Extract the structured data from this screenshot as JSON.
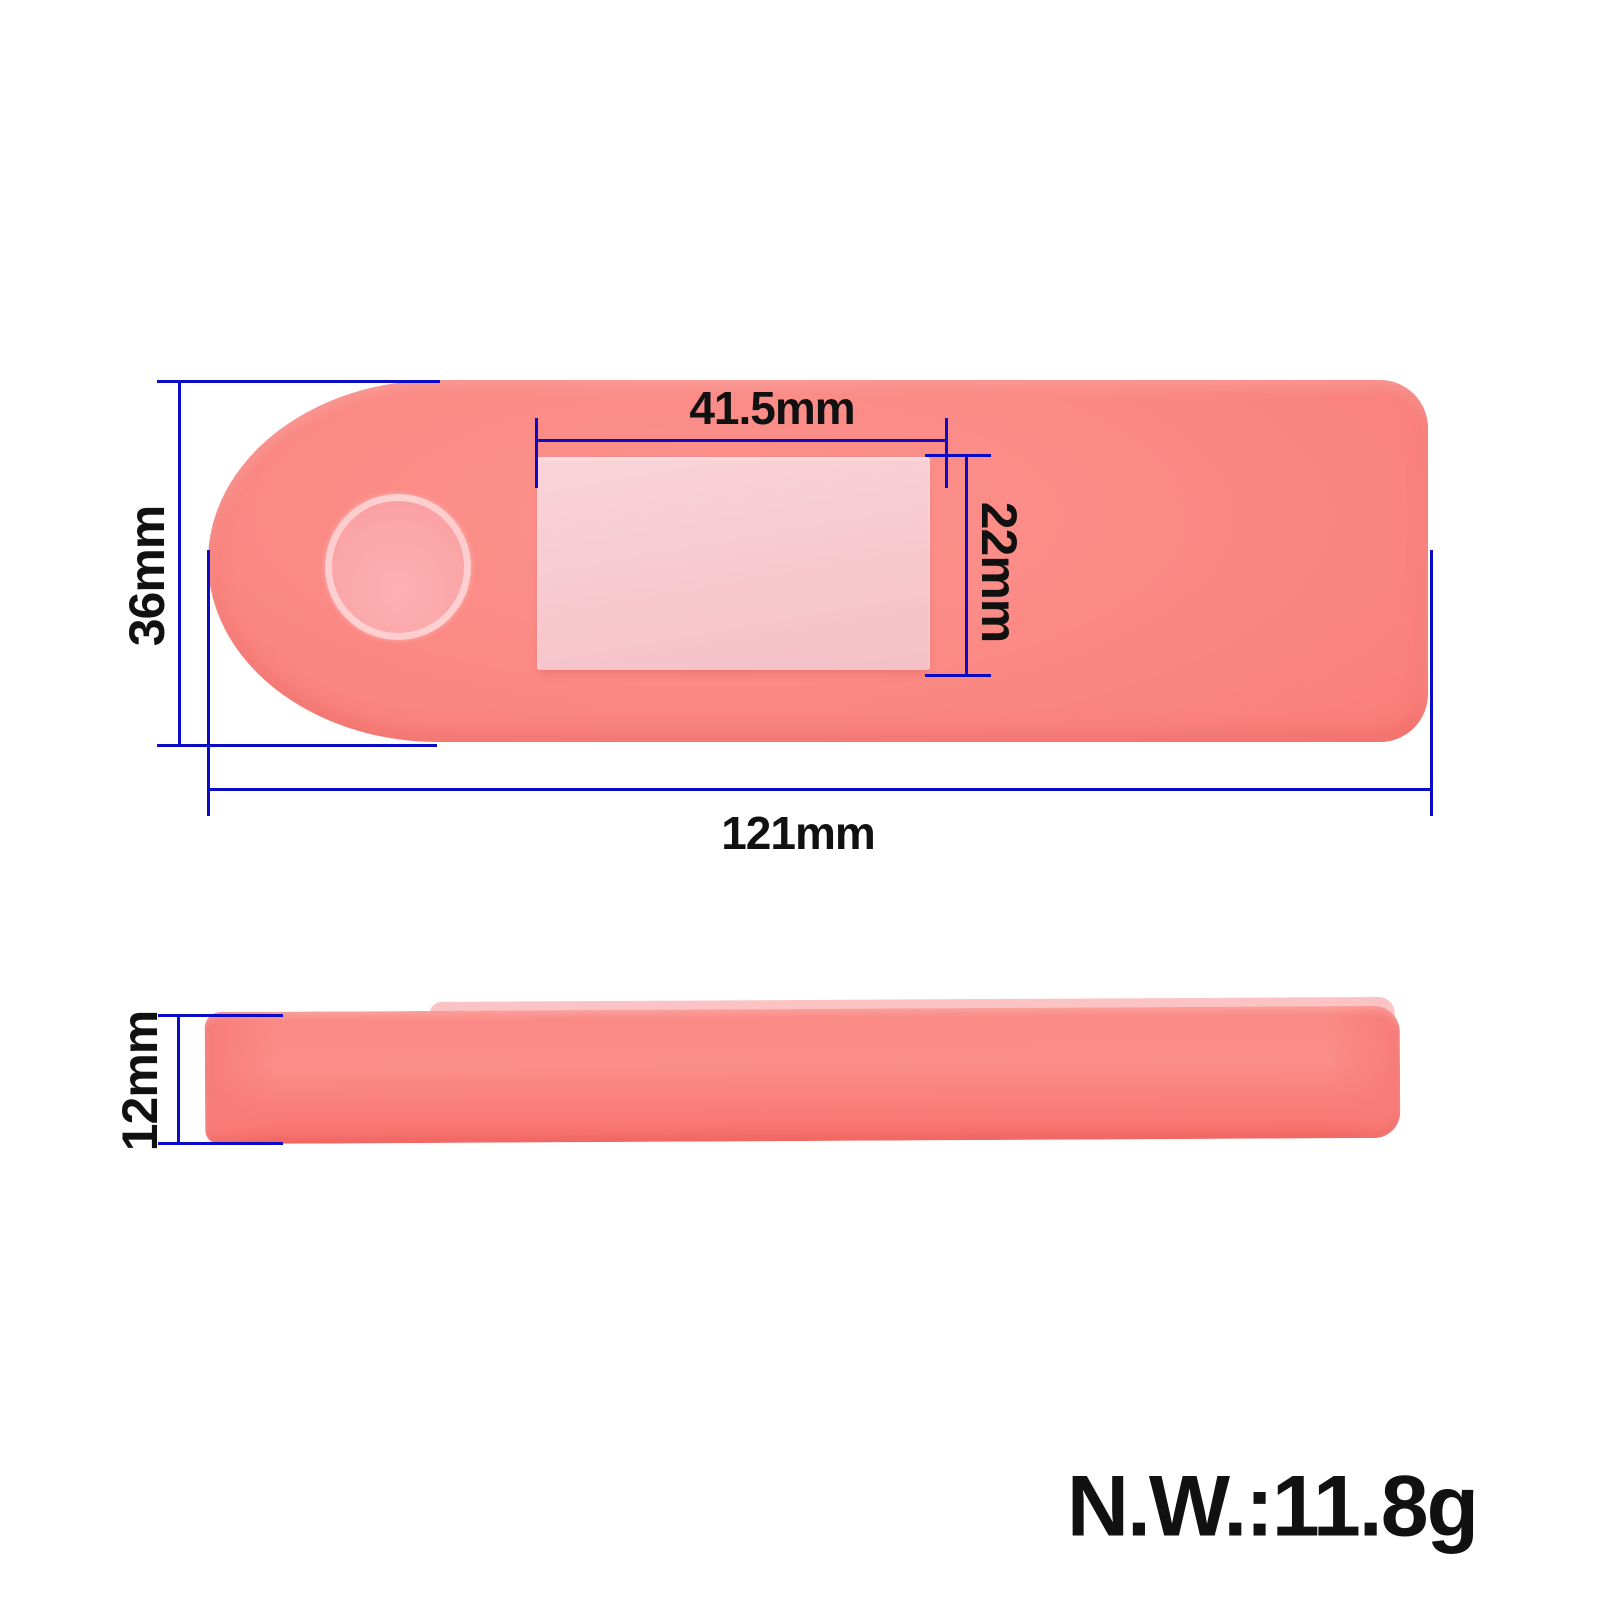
{
  "labels": {
    "screen_width": "41.5mm",
    "screen_height": "22mm",
    "body_height": "36mm",
    "body_width": "121mm",
    "thickness": "12mm",
    "net_weight": "N.W.:11.8g"
  },
  "views": {
    "top": "dashboard-cover-top-view",
    "side": "dashboard-cover-side-view"
  },
  "colors": {
    "body": "#fa827d",
    "body_edge": "#f8706c",
    "screen_window": "#f6c9cf",
    "button": "#fba6a8",
    "side_rim": "#fbc3c3",
    "dimension_line": "#0c0cc8",
    "label_text": "#111111",
    "background": "#ffffff"
  }
}
